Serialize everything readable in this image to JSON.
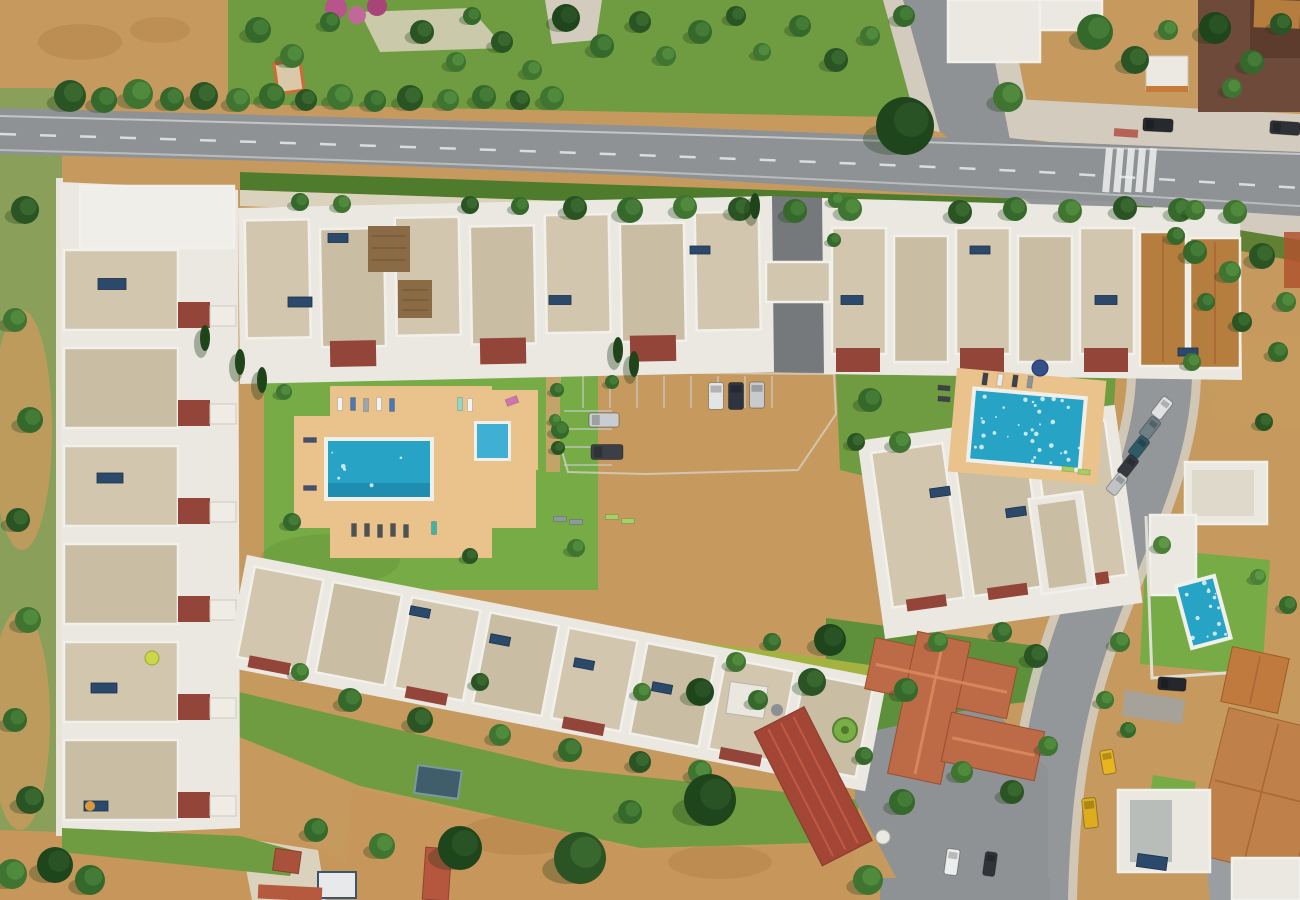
{
  "meta": {
    "description": "Aerial drone photograph, top-down, of a Mediterranean holiday apartment complex with white and beige flat-roofed townhouse rows, a large communal swimming pool with sun loungers, a second communal pool, a car park, a main road with tree-lined verges, a curving side street with parked cars and a yellow taxi, terracotta-roofed villas, a private villa pool, green lawns and dry ochre fields"
  },
  "palette": {
    "fieldTan": "#c69a5e",
    "fieldDark": "#ad8048",
    "fieldLight": "#d8b67c",
    "fieldBottom": "#c7965a",
    "lawn": "#6f9c40",
    "lawnBright": "#76ab46",
    "lawnDark": "#5e8f3a",
    "hedge": "#4e7c2c",
    "hedgeYellow": "#a3b241",
    "roadMain": "#8f9295",
    "parking": "#5f6266",
    "internalRoad": "#76797c",
    "sidewalk": "#d3ccbe",
    "path": "#dbd2bd",
    "kerbTan": "#c2a368",
    "slab": "#eae8e1",
    "roofBeige": "#d2c7ae",
    "roofBeige2": "#c9bda3",
    "roofWhite": "#f0eee8",
    "maroon": "#93453a",
    "roofOrange": "#b57d3e",
    "terracotta": "#bd6a47",
    "tanTile": "#c08049",
    "redMetal": "#a34635",
    "deck": "#e9c28c",
    "poolMain": "#27a3c6",
    "poolDeep": "#1d87aa",
    "poolLight": "#3fb0d4",
    "rim": "#f0efe9",
    "treeShadow": "#1e3a18",
    "brown": "#6d4a3a",
    "solar": "#2b4a6b",
    "taxi": "#e6b51f",
    "busStop": "#b05045",
    "fence": "#b0542f",
    "shedBlue": "#3f5d6b",
    "greenCircle": "#79ad46",
    "pink1": "#b8538b",
    "pink2": "#c06898",
    "pink3": "#a84478"
  },
  "treeGreens": [
    "#2a5423",
    "#35682b",
    "#3f7431",
    "#4b8036",
    "#1f451c"
  ],
  "treeGreensLight": [
    "#3c6c30",
    "#47803a",
    "#538f40",
    "#5f9c48",
    "#2c5626"
  ],
  "scene": {
    "trees": [
      [
        70,
        96,
        16,
        0
      ],
      [
        104,
        100,
        13,
        1
      ],
      [
        138,
        94,
        15,
        2
      ],
      [
        172,
        99,
        12,
        1
      ],
      [
        204,
        96,
        14,
        0
      ],
      [
        238,
        100,
        12,
        2
      ],
      [
        272,
        96,
        13,
        1
      ],
      [
        306,
        100,
        11,
        0
      ],
      [
        340,
        97,
        13,
        2
      ],
      [
        375,
        101,
        11,
        1
      ],
      [
        410,
        98,
        13,
        0
      ],
      [
        448,
        100,
        11,
        2
      ],
      [
        484,
        97,
        12,
        1
      ],
      [
        520,
        100,
        10,
        0
      ],
      [
        552,
        98,
        12,
        2
      ],
      [
        258,
        30,
        13,
        1
      ],
      [
        292,
        56,
        12,
        2
      ],
      [
        330,
        22,
        10,
        1
      ],
      [
        422,
        32,
        12,
        0
      ],
      [
        456,
        62,
        10,
        2
      ],
      [
        472,
        16,
        9,
        1
      ],
      [
        502,
        42,
        11,
        0
      ],
      [
        532,
        70,
        10,
        2
      ],
      [
        566,
        18,
        14,
        4
      ],
      [
        602,
        46,
        12,
        1
      ],
      [
        640,
        22,
        11,
        0
      ],
      [
        666,
        56,
        10,
        2
      ],
      [
        700,
        32,
        12,
        1
      ],
      [
        736,
        16,
        10,
        0
      ],
      [
        762,
        52,
        9,
        2
      ],
      [
        800,
        26,
        11,
        1
      ],
      [
        836,
        60,
        12,
        0
      ],
      [
        870,
        36,
        10,
        2
      ],
      [
        904,
        16,
        11,
        1
      ],
      [
        905,
        126,
        29,
        4
      ],
      [
        1008,
        97,
        15,
        2
      ],
      [
        1095,
        32,
        18,
        1
      ],
      [
        1135,
        60,
        14,
        0
      ],
      [
        1168,
        30,
        10,
        2
      ],
      [
        1215,
        28,
        16,
        4
      ],
      [
        1252,
        62,
        12,
        1
      ],
      [
        1281,
        24,
        11,
        0
      ],
      [
        1232,
        88,
        10,
        2
      ],
      [
        575,
        208,
        12,
        0
      ],
      [
        630,
        210,
        13,
        1
      ],
      [
        685,
        207,
        12,
        2
      ],
      [
        740,
        209,
        12,
        0
      ],
      [
        795,
        211,
        12,
        1
      ],
      [
        850,
        209,
        12,
        2
      ],
      [
        960,
        212,
        12,
        0
      ],
      [
        1015,
        209,
        12,
        1
      ],
      [
        1070,
        211,
        12,
        2
      ],
      [
        1125,
        208,
        12,
        0
      ],
      [
        1180,
        210,
        12,
        1
      ],
      [
        1235,
        212,
        12,
        2
      ],
      [
        300,
        202,
        9,
        1
      ],
      [
        342,
        204,
        9,
        2
      ],
      [
        470,
        205,
        9,
        0
      ],
      [
        520,
        206,
        9,
        1
      ],
      [
        25,
        210,
        14,
        0
      ],
      [
        15,
        320,
        12,
        2
      ],
      [
        30,
        420,
        13,
        1
      ],
      [
        18,
        520,
        12,
        0
      ],
      [
        28,
        620,
        13,
        2
      ],
      [
        15,
        720,
        12,
        1
      ],
      [
        30,
        800,
        14,
        0
      ],
      [
        55,
        865,
        18,
        4
      ],
      [
        12,
        874,
        15,
        2
      ],
      [
        90,
        880,
        15,
        1
      ],
      [
        284,
        392,
        8,
        2
      ],
      [
        292,
        522,
        9,
        1
      ],
      [
        470,
        556,
        8,
        0
      ],
      [
        560,
        430,
        9,
        1
      ],
      [
        576,
        548,
        9,
        2
      ],
      [
        612,
        382,
        7,
        1
      ],
      [
        557,
        390,
        7,
        1
      ],
      [
        555,
        420,
        6,
        2
      ],
      [
        558,
        448,
        7,
        0
      ],
      [
        870,
        400,
        12,
        1
      ],
      [
        900,
        442,
        11,
        2
      ],
      [
        856,
        442,
        9,
        0
      ],
      [
        836,
        200,
        8,
        2
      ],
      [
        834,
        240,
        7,
        1
      ],
      [
        350,
        700,
        12,
        1
      ],
      [
        420,
        720,
        13,
        0
      ],
      [
        500,
        735,
        11,
        2
      ],
      [
        570,
        750,
        12,
        1
      ],
      [
        640,
        762,
        11,
        0
      ],
      [
        700,
        772,
        12,
        2
      ],
      [
        758,
        700,
        10,
        1
      ],
      [
        642,
        692,
        9,
        2
      ],
      [
        480,
        682,
        9,
        0
      ],
      [
        300,
        672,
        9,
        2
      ],
      [
        830,
        640,
        16,
        4
      ],
      [
        812,
        682,
        14,
        0
      ],
      [
        906,
        690,
        12,
        1
      ],
      [
        938,
        642,
        10,
        2
      ],
      [
        1002,
        632,
        10,
        1
      ],
      [
        1036,
        656,
        12,
        0
      ],
      [
        962,
        772,
        11,
        2
      ],
      [
        902,
        802,
        13,
        1
      ],
      [
        1012,
        792,
        12,
        0
      ],
      [
        1048,
        746,
        10,
        2
      ],
      [
        864,
        756,
        9,
        1
      ],
      [
        700,
        692,
        14,
        4
      ],
      [
        736,
        662,
        10,
        2
      ],
      [
        772,
        642,
        9,
        1
      ],
      [
        710,
        800,
        26,
        4
      ],
      [
        460,
        848,
        22,
        4
      ],
      [
        580,
        858,
        26,
        0
      ],
      [
        316,
        830,
        12,
        1
      ],
      [
        382,
        846,
        13,
        2
      ],
      [
        630,
        812,
        12,
        1
      ],
      [
        868,
        880,
        15,
        2
      ],
      [
        1195,
        252,
        12,
        1
      ],
      [
        1230,
        272,
        11,
        2
      ],
      [
        1262,
        256,
        13,
        0
      ],
      [
        1286,
        302,
        10,
        2
      ],
      [
        1206,
        302,
        9,
        1
      ],
      [
        1242,
        322,
        10,
        0
      ],
      [
        1192,
        362,
        9,
        2
      ],
      [
        1278,
        352,
        10,
        1
      ],
      [
        1264,
        422,
        9,
        0
      ],
      [
        1195,
        210,
        10,
        2
      ],
      [
        1176,
        236,
        9,
        1
      ],
      [
        1120,
        642,
        10,
        2
      ],
      [
        1162,
        545,
        9,
        3
      ],
      [
        1258,
        577,
        8,
        3
      ],
      [
        1288,
        605,
        9,
        1
      ],
      [
        1105,
        700,
        9,
        2
      ],
      [
        1128,
        730,
        8,
        1
      ]
    ],
    "cypresses": [
      [
        205,
        338
      ],
      [
        240,
        362
      ],
      [
        262,
        380
      ],
      [
        618,
        350
      ],
      [
        634,
        364
      ],
      [
        755,
        206
      ]
    ],
    "cars": [
      [
        604,
        420,
        30,
        14,
        0,
        "#c9ccd0"
      ],
      [
        607,
        452,
        32,
        15,
        0,
        "#3b4047"
      ],
      [
        716,
        396,
        15,
        27,
        0,
        "#e2e4e6"
      ],
      [
        736,
        396,
        15,
        27,
        0,
        "#2d3442"
      ],
      [
        757,
        395,
        15,
        26,
        0,
        "#c7cbce"
      ],
      [
        1158,
        125,
        30,
        13,
        3,
        "#26292d"
      ],
      [
        1285,
        128,
        30,
        13,
        4,
        "#2e3236"
      ],
      [
        1162,
        408,
        12,
        22,
        38,
        "#dfe1e3"
      ],
      [
        1150,
        428,
        12,
        22,
        38,
        "#6e7f86"
      ],
      [
        1139,
        447,
        12,
        22,
        38,
        "#2f5a68"
      ],
      [
        1128,
        466,
        12,
        22,
        38,
        "#35393f"
      ],
      [
        1117,
        484,
        12,
        22,
        38,
        "#bfc3c6"
      ],
      [
        1108,
        762,
        13,
        24,
        -10,
        "#e6b51f"
      ],
      [
        1090,
        813,
        14,
        30,
        -6,
        "#ddad1e"
      ],
      [
        1172,
        684,
        28,
        13,
        4,
        "#24272c"
      ],
      [
        952,
        862,
        13,
        26,
        8,
        "#eceeee"
      ],
      [
        990,
        864,
        12,
        24,
        8,
        "#303439"
      ]
    ],
    "loungers": [
      [
        340,
        404,
        5,
        13,
        0,
        "#f2f3f4"
      ],
      [
        353,
        404,
        5,
        13,
        0,
        "#4a7ab5"
      ],
      [
        366,
        405,
        5,
        13,
        0,
        "#9aa5ae"
      ],
      [
        379,
        404,
        5,
        13,
        0,
        "#f2f3f4"
      ],
      [
        392,
        405,
        5,
        13,
        0,
        "#4a7ab5"
      ],
      [
        460,
        404,
        5,
        13,
        0,
        "#8fd8cf"
      ],
      [
        470,
        405,
        5,
        13,
        0,
        "#f2f3f4"
      ],
      [
        310,
        440,
        13,
        5,
        0,
        "#44506e"
      ],
      [
        310,
        488,
        13,
        5,
        0,
        "#44506e"
      ],
      [
        354,
        530,
        5,
        13,
        0,
        "#4a5258"
      ],
      [
        367,
        530,
        5,
        13,
        0,
        "#4a5258"
      ],
      [
        380,
        531,
        5,
        13,
        0,
        "#4a5258"
      ],
      [
        393,
        530,
        5,
        13,
        0,
        "#4a5258"
      ],
      [
        406,
        531,
        5,
        13,
        0,
        "#4a5258"
      ],
      [
        434,
        528,
        5,
        13,
        0,
        "#3fb3a5"
      ],
      [
        560,
        519,
        13,
        5,
        0,
        "#8d98a0"
      ],
      [
        576,
        522,
        13,
        5,
        0,
        "#8d98a0"
      ],
      [
        612,
        517,
        13,
        5,
        0,
        "#a5cf68"
      ],
      [
        628,
        521,
        13,
        5,
        0,
        "#a5cf68"
      ],
      [
        512,
        401,
        12,
        7,
        -20,
        "#cf74b2"
      ],
      [
        985,
        379,
        5,
        12,
        8,
        "#3c424a"
      ],
      [
        1000,
        380,
        5,
        12,
        8,
        "#eceff1"
      ],
      [
        1015,
        381,
        5,
        12,
        8,
        "#3c424a"
      ],
      [
        1030,
        382,
        5,
        12,
        8,
        "#8a949b"
      ],
      [
        944,
        388,
        12,
        5,
        5,
        "#3c424a"
      ],
      [
        944,
        399,
        12,
        5,
        5,
        "#3c424a"
      ],
      [
        1068,
        469,
        12,
        5,
        5,
        "#a5cf5e"
      ],
      [
        1084,
        472,
        12,
        5,
        5,
        "#a5cf5e"
      ]
    ],
    "solar": [
      [
        112,
        284,
        28,
        11,
        0
      ],
      [
        110,
        478,
        26,
        10,
        0
      ],
      [
        104,
        688,
        26,
        10,
        0
      ],
      [
        96,
        806,
        24,
        10,
        0
      ],
      [
        300,
        302,
        24,
        10,
        0
      ],
      [
        338,
        238,
        20,
        9,
        0
      ],
      [
        560,
        300,
        22,
        9,
        0
      ],
      [
        700,
        250,
        20,
        8,
        0
      ],
      [
        852,
        300,
        22,
        9,
        0
      ],
      [
        980,
        250,
        20,
        8,
        0
      ],
      [
        1106,
        300,
        22,
        9,
        0
      ],
      [
        1188,
        352,
        20,
        8,
        0
      ],
      [
        420,
        612,
        20,
        9,
        11
      ],
      [
        500,
        640,
        20,
        9,
        11
      ],
      [
        584,
        664,
        20,
        9,
        11
      ],
      [
        662,
        688,
        20,
        9,
        11
      ],
      [
        940,
        492,
        20,
        9,
        -8
      ],
      [
        1016,
        512,
        20,
        9,
        -8
      ],
      [
        1152,
        862,
        30,
        13,
        8
      ]
    ],
    "roofRows": [
      {
        "t": "rotate(-1 500 290)",
        "dir": "h",
        "x0": 246,
        "y0": 216,
        "step": 75,
        "count": 7,
        "w": 64,
        "h": 118,
        "stag": 10,
        "acc": [
          8,
          112,
          46,
          26
        ],
        "accIdx": [
          1,
          3,
          5
        ]
      },
      {
        "t": "",
        "dir": "h",
        "x0": 832,
        "y0": 228,
        "step": 62,
        "count": 5,
        "w": 54,
        "h": 126,
        "stag": 8,
        "acc": [
          4,
          120,
          44,
          24
        ],
        "accIdx": [
          0,
          2,
          4
        ]
      },
      {
        "t": "",
        "dir": "v",
        "x0": 64,
        "y0": 250,
        "step": 98,
        "count": 6,
        "w": 114,
        "h": 80,
        "stag": 0,
        "acc": [
          114,
          52,
          32,
          26
        ],
        "accIdx": [
          0,
          1,
          2,
          3,
          4,
          5
        ],
        "shed": [
          146,
          56,
          26,
          20
        ]
      },
      {
        "t": "translate(252,560) rotate(11)",
        "base": [
          -6,
          -4,
          652,
          114
        ],
        "dir": "h",
        "x0": 4,
        "y0": 6,
        "step": 80,
        "count": 8,
        "w": 70,
        "h": 92,
        "stag": 0,
        "acc": [
          12,
          88,
          42,
          12
        ],
        "accIdx": [
          0,
          2,
          4,
          6
        ]
      },
      {
        "t": "translate(864,446) rotate(-8)",
        "base": [
          -6,
          -6,
          260,
          200
        ],
        "dir": "h",
        "x0": 6,
        "y0": 8,
        "step": 82,
        "count": 3,
        "w": 72,
        "h": 156,
        "stag": 0,
        "acc": [
          14,
          150,
          40,
          12
        ],
        "accIdx": [
          0,
          1,
          2
        ]
      }
    ],
    "stripes": {
      "v": {
        "x0": 583,
        "y": 376,
        "len": 32,
        "step": 27,
        "count": 8
      },
      "h": {
        "x": 564,
        "len": 48,
        "y0": 411,
        "step": 18,
        "count": 4
      }
    },
    "zebra": {
      "x": 1106,
      "y": 148,
      "step": 11,
      "count": 5,
      "w": 7,
      "h": 44,
      "rot": 5
    },
    "sparkles": [
      {
        "cx": 1025,
        "cy": 428,
        "rot": 5,
        "x": 973,
        "y": 396,
        "w": 108,
        "h": 66,
        "n": 34,
        "s": 7
      },
      {
        "cx": 1203,
        "cy": 612,
        "rot": -15,
        "x": 1185,
        "y": 583,
        "w": 36,
        "h": 58,
        "n": 14,
        "s": 3
      },
      {
        "cx": 379,
        "cy": 469,
        "rot": 0,
        "x": 330,
        "y": 444,
        "w": 98,
        "h": 50,
        "n": 6,
        "s": 11
      }
    ]
  }
}
